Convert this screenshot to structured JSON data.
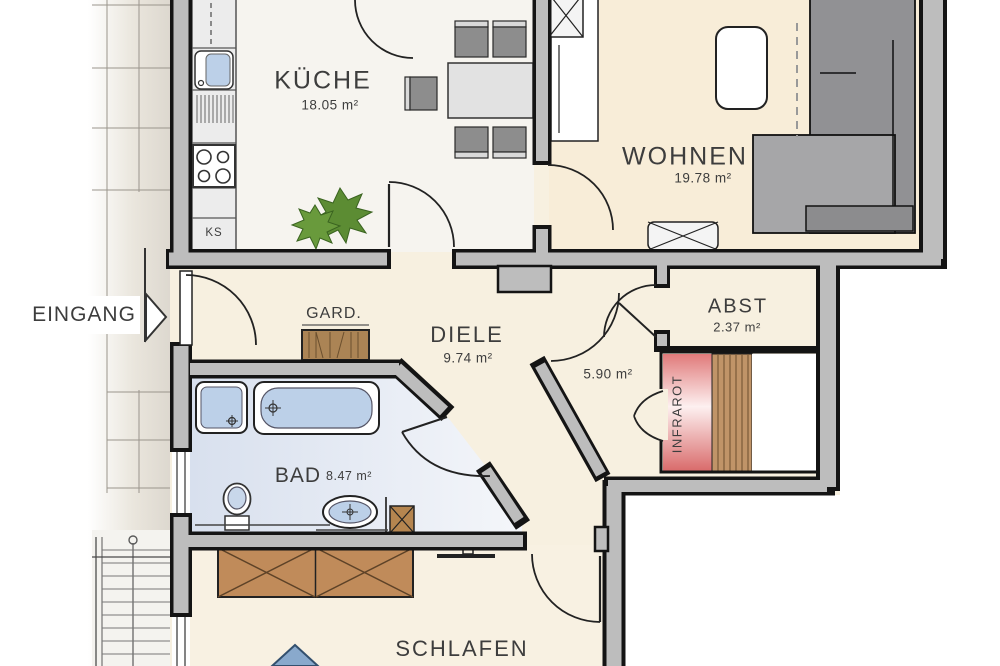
{
  "rooms": {
    "kueche": {
      "name": "KÜCHE",
      "area": "18.05 m²"
    },
    "wohnen": {
      "name": "WOHNEN",
      "area": "19.78 m²"
    },
    "diele": {
      "name": "DIELE",
      "area": "9.74 m²"
    },
    "garderobe": {
      "name": "GARD."
    },
    "abstellraum": {
      "name": "ABST",
      "area": "2.37 m²"
    },
    "bad": {
      "name": "BAD",
      "area": "8.47 m²"
    },
    "schlafen": {
      "name": "SCHLAFEN"
    },
    "flur": {
      "area": "5.90 m²"
    }
  },
  "annotations": {
    "entrance_label": "EINGANG",
    "entrance_arrow_icon": "right-pointing-triangle",
    "fridge_label": "KS",
    "sauna_label": "INFRAROT"
  },
  "colors": {
    "wall_fill": "#bdbdbd",
    "wall_line": "#141414",
    "floor_main": "#f7f0e0",
    "floor_wohnen": "#f8edd8",
    "floor_kueche": "#f6f4ef",
    "floor_bad": "#dce3ef",
    "floor_schlafen": "#f8f1e2",
    "water_blue": "#bcd0e8",
    "wood_brown": "#c08b5a",
    "sauna_red": "#d96b6b",
    "plant_green": "#5c8c33",
    "sofa_gray": "#9a9a9c",
    "text": "#3d3d3d"
  }
}
